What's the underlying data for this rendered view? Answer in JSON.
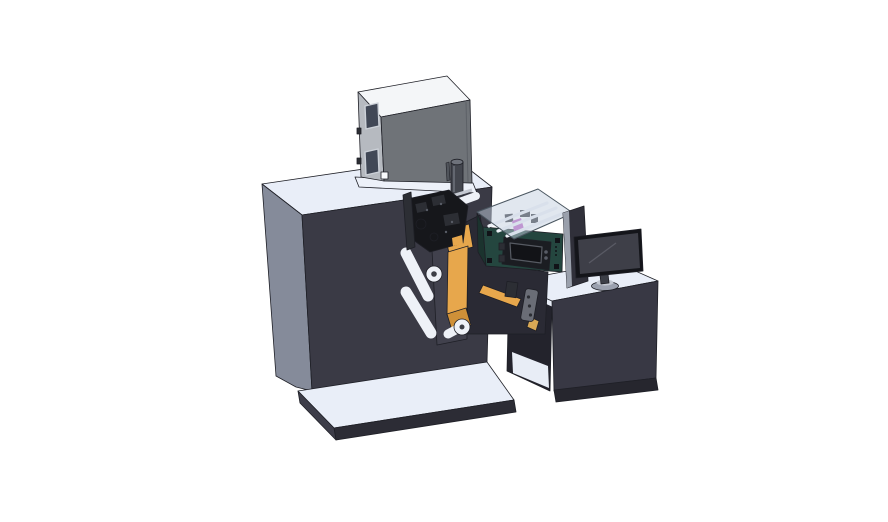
{
  "scene": {
    "description": "3D CAD rendering of an industrial label printing and rewinding machine with guide rollers, an orange label web, a green applicator enclosure with transparent lid and HMI panel, and an operator desk with a monitor, on a white background"
  },
  "colors": {
    "background": "#ffffff",
    "edge": "#1e1f26",
    "surface_light": "#e9eef8",
    "machine_front": "#3a3a45",
    "machine_side": "#858b9a",
    "base_front": "#2c2c35",
    "base_side": "#3d3d49",
    "box_top": "#f4f6f8",
    "box_side": "#b6bac0",
    "box_front": "#6f7378",
    "box_seam": "#5d6167",
    "box_window": "#414856",
    "box_slot": "#50545b",
    "cylinder_dark": "#43464e",
    "cylinder_top": "#6e727b",
    "ledge_white": "#edf1f9",
    "white_square": "#f8fafc",
    "desk_front": "#383844",
    "desk_side": "#23232c",
    "desk_plinth": "#26262e",
    "desk_interior": "#e8edf6",
    "under_mass": "#2a2a34",
    "plate_front": "#41414d",
    "plate_top": "#71758a",
    "web_orange": "#e7a74c",
    "web_orange_dark": "#cf9038",
    "tan": "#d8a855",
    "roller": "#eef1f7",
    "rail": "#c5c9d2",
    "roller_dot": "#3c3e46",
    "mech_dark": "#16171b",
    "mech_mid": "#2c2e34",
    "mech_light": "#585c66",
    "green_face": "#24463f",
    "green_side": "#1b332e",
    "glass": "#c3cfdf",
    "magenta": "#bb5fc4",
    "hmi_body": "#1b1d22",
    "hmi_screen": "#121317",
    "pad_dark": "#111318",
    "bracket_gray": "#6a6d76",
    "panel_dark": "#30303a",
    "panel_edge": "#9aa0ac",
    "monitor_bezel": "#14151a",
    "monitor_screen": "#3e3f48",
    "monitor_reflection": "#595a64",
    "stand_dark": "#3c3f48",
    "stand_base": "#9ba1af",
    "stand_base_top": "#c3c8d2"
  }
}
